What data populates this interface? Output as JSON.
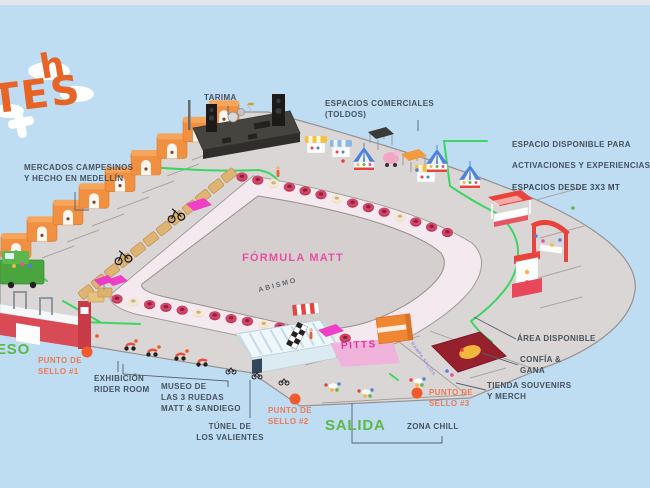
{
  "labels": {
    "tarima": "TARIMA",
    "espacios_comerciales": "ESPACIOS COMERCIALES\n(TOLDOS)",
    "espacio_disponible_1": "ESPACIO DISPONIBLE PARA",
    "espacio_disponible_2": "ACTIVACIONES Y EXPERIENCIAS",
    "espacio_disponible_3": "ESPACIOS DESDE 3X3 MT",
    "mercados": "MERCADOS CAMPESINOS\nY HECHO EN MEDELLÍN",
    "formula_matt": "FÓRMULA MATT",
    "abismo": "ABISMO",
    "pitts": "PITTS",
    "area_disponible": "ÁREA DISPONIBLE",
    "confia_gana": "CONFÍA &\nGANA",
    "tienda_souvenirs": "TIENDA SOUVENIRS\nY MERCH",
    "punto_sello_1": "PUNTO DE\nSELLO #1",
    "punto_sello_2": "PUNTO DE\nSELLO #2",
    "punto_sello_3": "PUNTO DE\nSELLO #3",
    "zona_chill": "ZONA CHILL",
    "salida": "SALIDA",
    "ingreso_fragment": "ESO",
    "exhibicion": "EXHIBICIÓN\nRIDER ROOM",
    "museo": "MUSEO DE\nLAS 3 RUEDAS\nMATT & SANDIEGO",
    "tunel": "TÚNEL DE\nLOS VALIENTES",
    "rampa_salida": "RAMPA SALIDA",
    "logo_line1": "h",
    "logo_line2": "TES"
  },
  "colors": {
    "background_sky": "#bedcf2",
    "plaza_gray": "#dad6d5",
    "track_pink": "#f4e9ef",
    "accent_magenta": "#e84f9e",
    "accent_green": "#5cb847",
    "route_green": "#3ed463",
    "accent_orange_label": "#ef7a52",
    "sello_dot_orange": "#f15b2c",
    "barrier_red": "#bd3354",
    "stall_orange": "#f19040",
    "logo_orange": "#e76427"
  }
}
